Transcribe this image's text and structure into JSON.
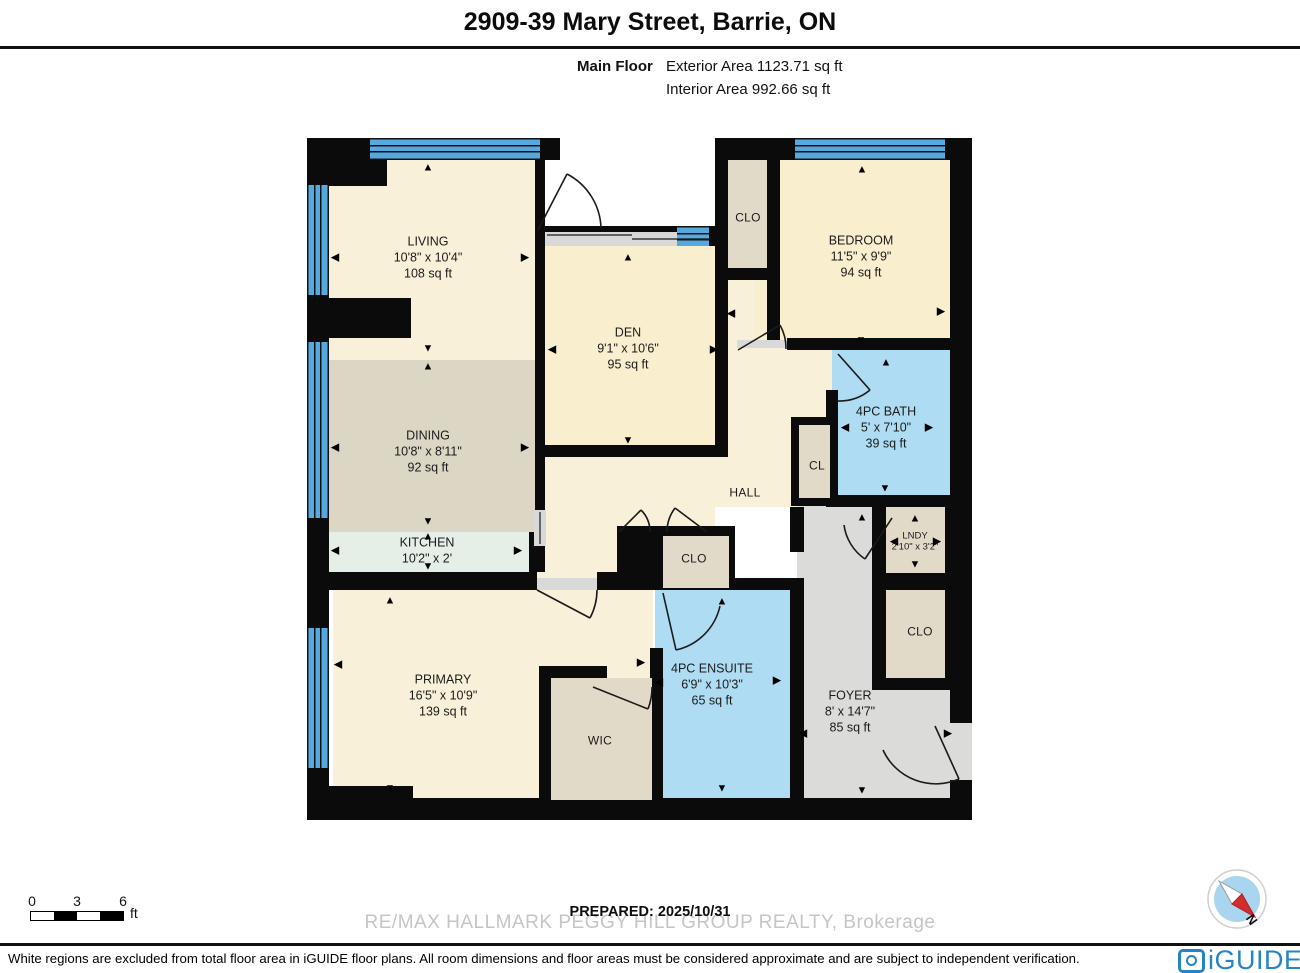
{
  "header": {
    "title": "2909-39 Mary Street, Barrie, ON",
    "floor_label": "Main Floor",
    "exterior_area": "Exterior Area 1123.71 sq ft",
    "interior_area": "Interior Area 992.66 sq ft"
  },
  "rooms": {
    "living": {
      "name": "LIVING",
      "dims": "10'8\" x 10'4\"",
      "area": "108 sq ft"
    },
    "dining": {
      "name": "DINING",
      "dims": "10'8\" x 8'11\"",
      "area": "92 sq ft"
    },
    "kitchen": {
      "name": "KITCHEN",
      "dims": "10'2\" x 2'"
    },
    "den": {
      "name": "DEN",
      "dims": "9'1\" x 10'6\"",
      "area": "95 sq ft"
    },
    "bedroom": {
      "name": "BEDROOM",
      "dims": "11'5\" x 9'9\"",
      "area": "94 sq ft"
    },
    "bath": {
      "name": "4PC BATH",
      "dims": "5' x 7'10\"",
      "area": "39 sq ft"
    },
    "primary": {
      "name": "PRIMARY",
      "dims": "16'5\" x 10'9\"",
      "area": "139 sq ft"
    },
    "ensuite": {
      "name": "4PC ENSUITE",
      "dims": "6'9\" x 10'3\"",
      "area": "65 sq ft"
    },
    "foyer": {
      "name": "FOYER",
      "dims": "8' x 14'7\"",
      "area": "85 sq ft"
    },
    "hall": {
      "name": "HALL"
    },
    "lndy": {
      "name": "LNDY",
      "dims": "2'10\" x 3'2\""
    },
    "clo_top": {
      "name": "CLO"
    },
    "cl": {
      "name": "CL"
    },
    "clo_hall": {
      "name": "CLO"
    },
    "clo_right": {
      "name": "CLO"
    },
    "wic": {
      "name": "WIC"
    }
  },
  "icons": {
    "up": "▲",
    "down": "▼",
    "left": "◀",
    "right": "▶"
  },
  "plan": {
    "arrows": [
      {
        "x": 121,
        "y": 30,
        "d": "up"
      },
      {
        "x": 28,
        "y": 120,
        "d": "left"
      },
      {
        "x": 218,
        "y": 120,
        "d": "right"
      },
      {
        "x": 121,
        "y": 211,
        "d": "down"
      },
      {
        "x": 121,
        "y": 229,
        "d": "up"
      },
      {
        "x": 28,
        "y": 310,
        "d": "left"
      },
      {
        "x": 218,
        "y": 310,
        "d": "right"
      },
      {
        "x": 121,
        "y": 384,
        "d": "down"
      },
      {
        "x": 121,
        "y": 399,
        "d": "up"
      },
      {
        "x": 28,
        "y": 413,
        "d": "left"
      },
      {
        "x": 211,
        "y": 413,
        "d": "right"
      },
      {
        "x": 121,
        "y": 429,
        "d": "down"
      },
      {
        "x": 321,
        "y": 120,
        "d": "up"
      },
      {
        "x": 245,
        "y": 212,
        "d": "left"
      },
      {
        "x": 407,
        "y": 212,
        "d": "right"
      },
      {
        "x": 321,
        "y": 303,
        "d": "down"
      },
      {
        "x": 555,
        "y": 32,
        "d": "up"
      },
      {
        "x": 424,
        "y": 176,
        "d": "left"
      },
      {
        "x": 634,
        "y": 174,
        "d": "right"
      },
      {
        "x": 554,
        "y": 203,
        "d": "down"
      },
      {
        "x": 579,
        "y": 225,
        "d": "up"
      },
      {
        "x": 538,
        "y": 290,
        "d": "left"
      },
      {
        "x": 622,
        "y": 290,
        "d": "right"
      },
      {
        "x": 578,
        "y": 351,
        "d": "down"
      },
      {
        "x": 608,
        "y": 381,
        "d": "up"
      },
      {
        "x": 587,
        "y": 404,
        "d": "left"
      },
      {
        "x": 630,
        "y": 404,
        "d": "right"
      },
      {
        "x": 608,
        "y": 427,
        "d": "down"
      },
      {
        "x": 83,
        "y": 463,
        "d": "up"
      },
      {
        "x": 31,
        "y": 527,
        "d": "left"
      },
      {
        "x": 334,
        "y": 525,
        "d": "right"
      },
      {
        "x": 83,
        "y": 651,
        "d": "down"
      },
      {
        "x": 415,
        "y": 464,
        "d": "up"
      },
      {
        "x": 352,
        "y": 545,
        "d": "left"
      },
      {
        "x": 470,
        "y": 543,
        "d": "right"
      },
      {
        "x": 415,
        "y": 651,
        "d": "down"
      },
      {
        "x": 555,
        "y": 380,
        "d": "up"
      },
      {
        "x": 496,
        "y": 596,
        "d": "left"
      },
      {
        "x": 641,
        "y": 596,
        "d": "right"
      },
      {
        "x": 555,
        "y": 653,
        "d": "down"
      }
    ]
  },
  "scale": {
    "t0": "0",
    "t3": "3",
    "t6": "6",
    "unit": "ft"
  },
  "prepared": "PREPARED: 2025/10/31",
  "watermark": "RE/MAX HALLMARK PEGGY HILL GROUP REALTY, Brokerage",
  "footnote": "White regions are excluded from total floor area in iGUIDE floor plans. All room dimensions and floor areas must be considered approximate and are subject to independent verification.",
  "brand": {
    "logo_text": "iGUIDE"
  },
  "compass": {
    "north": "N"
  },
  "colors": {
    "wall": "#0b0b0b",
    "window_blue": "#55a9de",
    "cream": "#f8f0d8",
    "cream_warm": "#f9eecd",
    "dining_tan": "#dcd6c5",
    "kitchen_mint": "#e5efe8",
    "closet_tan": "#e2dac9",
    "bath_blue": "#aedcf3",
    "foyer_gray": "#dbdbd9",
    "logo_blue": "#2484c6",
    "compass_red": "#d22c2c"
  }
}
